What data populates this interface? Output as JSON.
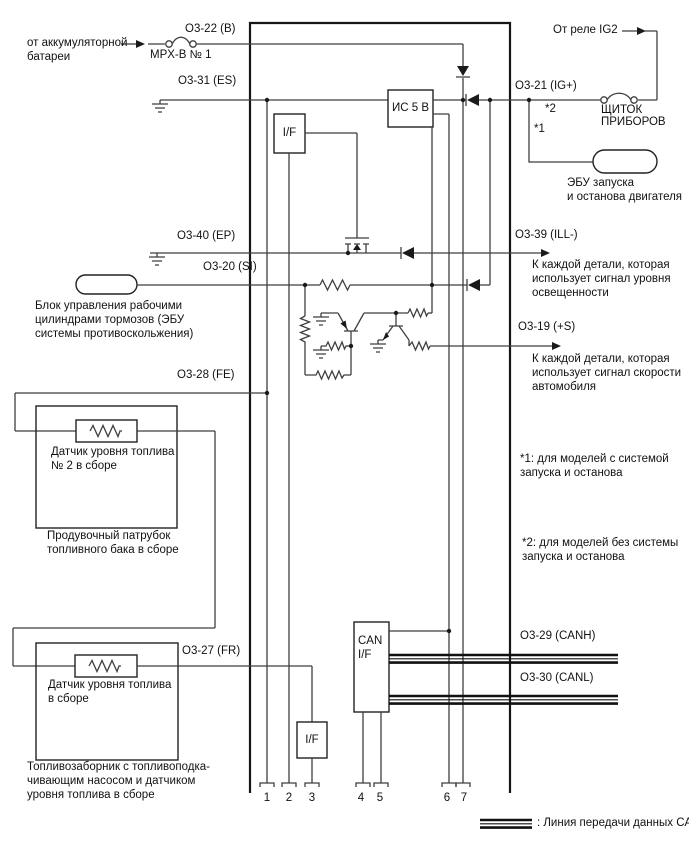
{
  "colors": {
    "background": "#ffffff",
    "wire": "#3f3f3f",
    "outline": "#161616",
    "text": "#111111"
  },
  "terminals": {
    "b": "O3-22 (B)",
    "es": "O3-31 (ES)",
    "ig": "O3-21 (IG+)",
    "ep": "O3-40 (EP)",
    "ill": "O3-39 (ILL-)",
    "si": "O3-20 (SI)",
    "s_plus": "O3-19 (+S)",
    "fe": "O3-28 (FE)",
    "fr": "O3-27 (FR)",
    "canh": "O3-29 (CANH)",
    "canl": "O3-30 (CANL)"
  },
  "ecu": {
    "ic_label": "ИС 5 В",
    "if_top_label": "I/F",
    "if_bottom_label": "I/F",
    "can_if_label": "CAN\nI/F"
  },
  "external": {
    "battery": "от аккумуляторной\nбатареи",
    "fuse_main": "MPX-B № 1",
    "relay": "От реле IG2",
    "fuse_panel": "ЩИТОК\nПРИБОРОВ",
    "start_stop_ecu": "ЭБУ запуска\nи останова двигателя",
    "brake_ecu": "Блок управления рабочими\nцилиндрами тормозов (ЭБУ\nсистемы противоскольжения)",
    "illumination_consumers": "К каждой детали, которая\nиспользует сигнал уровня\nосвещенности",
    "speed_consumers": "К каждой детали, которая\nиспользует сигнал скорости\nавтомобиля",
    "fuel_sensor2": "Датчик уровня топлива\n№ 2 в сборе",
    "purge_tube": "Продувочный патрубок\nтопливного бака в сборе",
    "fuel_sensor1": "Датчик уровня топлива\nв сборе",
    "fuel_pump": "Топливозаборник с топливоподка-\nчивающим насосом и датчиком\nуровня топлива в сборе"
  },
  "marks": {
    "star1": "*1",
    "star2": "*2"
  },
  "notes": {
    "note1": "*1: для моделей с системой\nзапуска и останова",
    "note2": "*2: для моделей без системы\nзапуска и останова"
  },
  "legend": {
    "can_line": ": Линия передачи данных CAN"
  },
  "pins": [
    "1",
    "2",
    "3",
    "4",
    "5",
    "6",
    "7"
  ]
}
